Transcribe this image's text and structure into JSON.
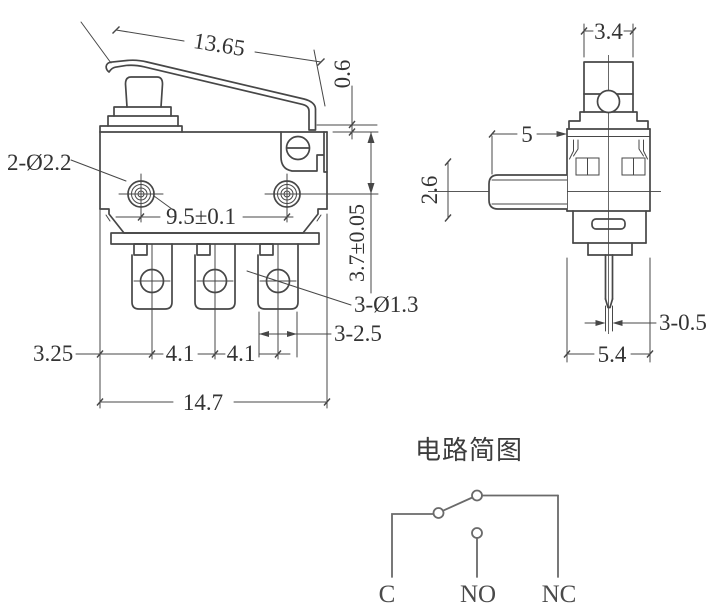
{
  "drawing": {
    "front_view": {
      "dim_lever_length": "13.65",
      "dim_lever_tip_gap": "0.6",
      "label_mounting_holes": "2-Ø2.2",
      "dim_hole_spacing": "9.5±0.1",
      "dim_top_to_hole": "3.7±0.05",
      "label_terminal_holes": "3-Ø1.3",
      "dim_terminal_width": "3-2.5",
      "dim_edge_to_terminal": "3.25",
      "dim_pitch_left": "4.1",
      "dim_pitch_right": "4.1",
      "dim_body_width": "14.7"
    },
    "side_view": {
      "dim_button_width": "3.4",
      "dim_lever_protrusion": "5",
      "dim_lever_height": "2.6",
      "dim_terminal_thickness": "3-0.5",
      "dim_body_depth": "5.4"
    },
    "circuit": {
      "title": "电路简图",
      "terminals": [
        "C",
        "NO",
        "NC"
      ]
    },
    "colors": {
      "line": "#474747",
      "circuit_line": "#6a6a6a",
      "text": "#333333",
      "background": "#ffffff"
    }
  }
}
